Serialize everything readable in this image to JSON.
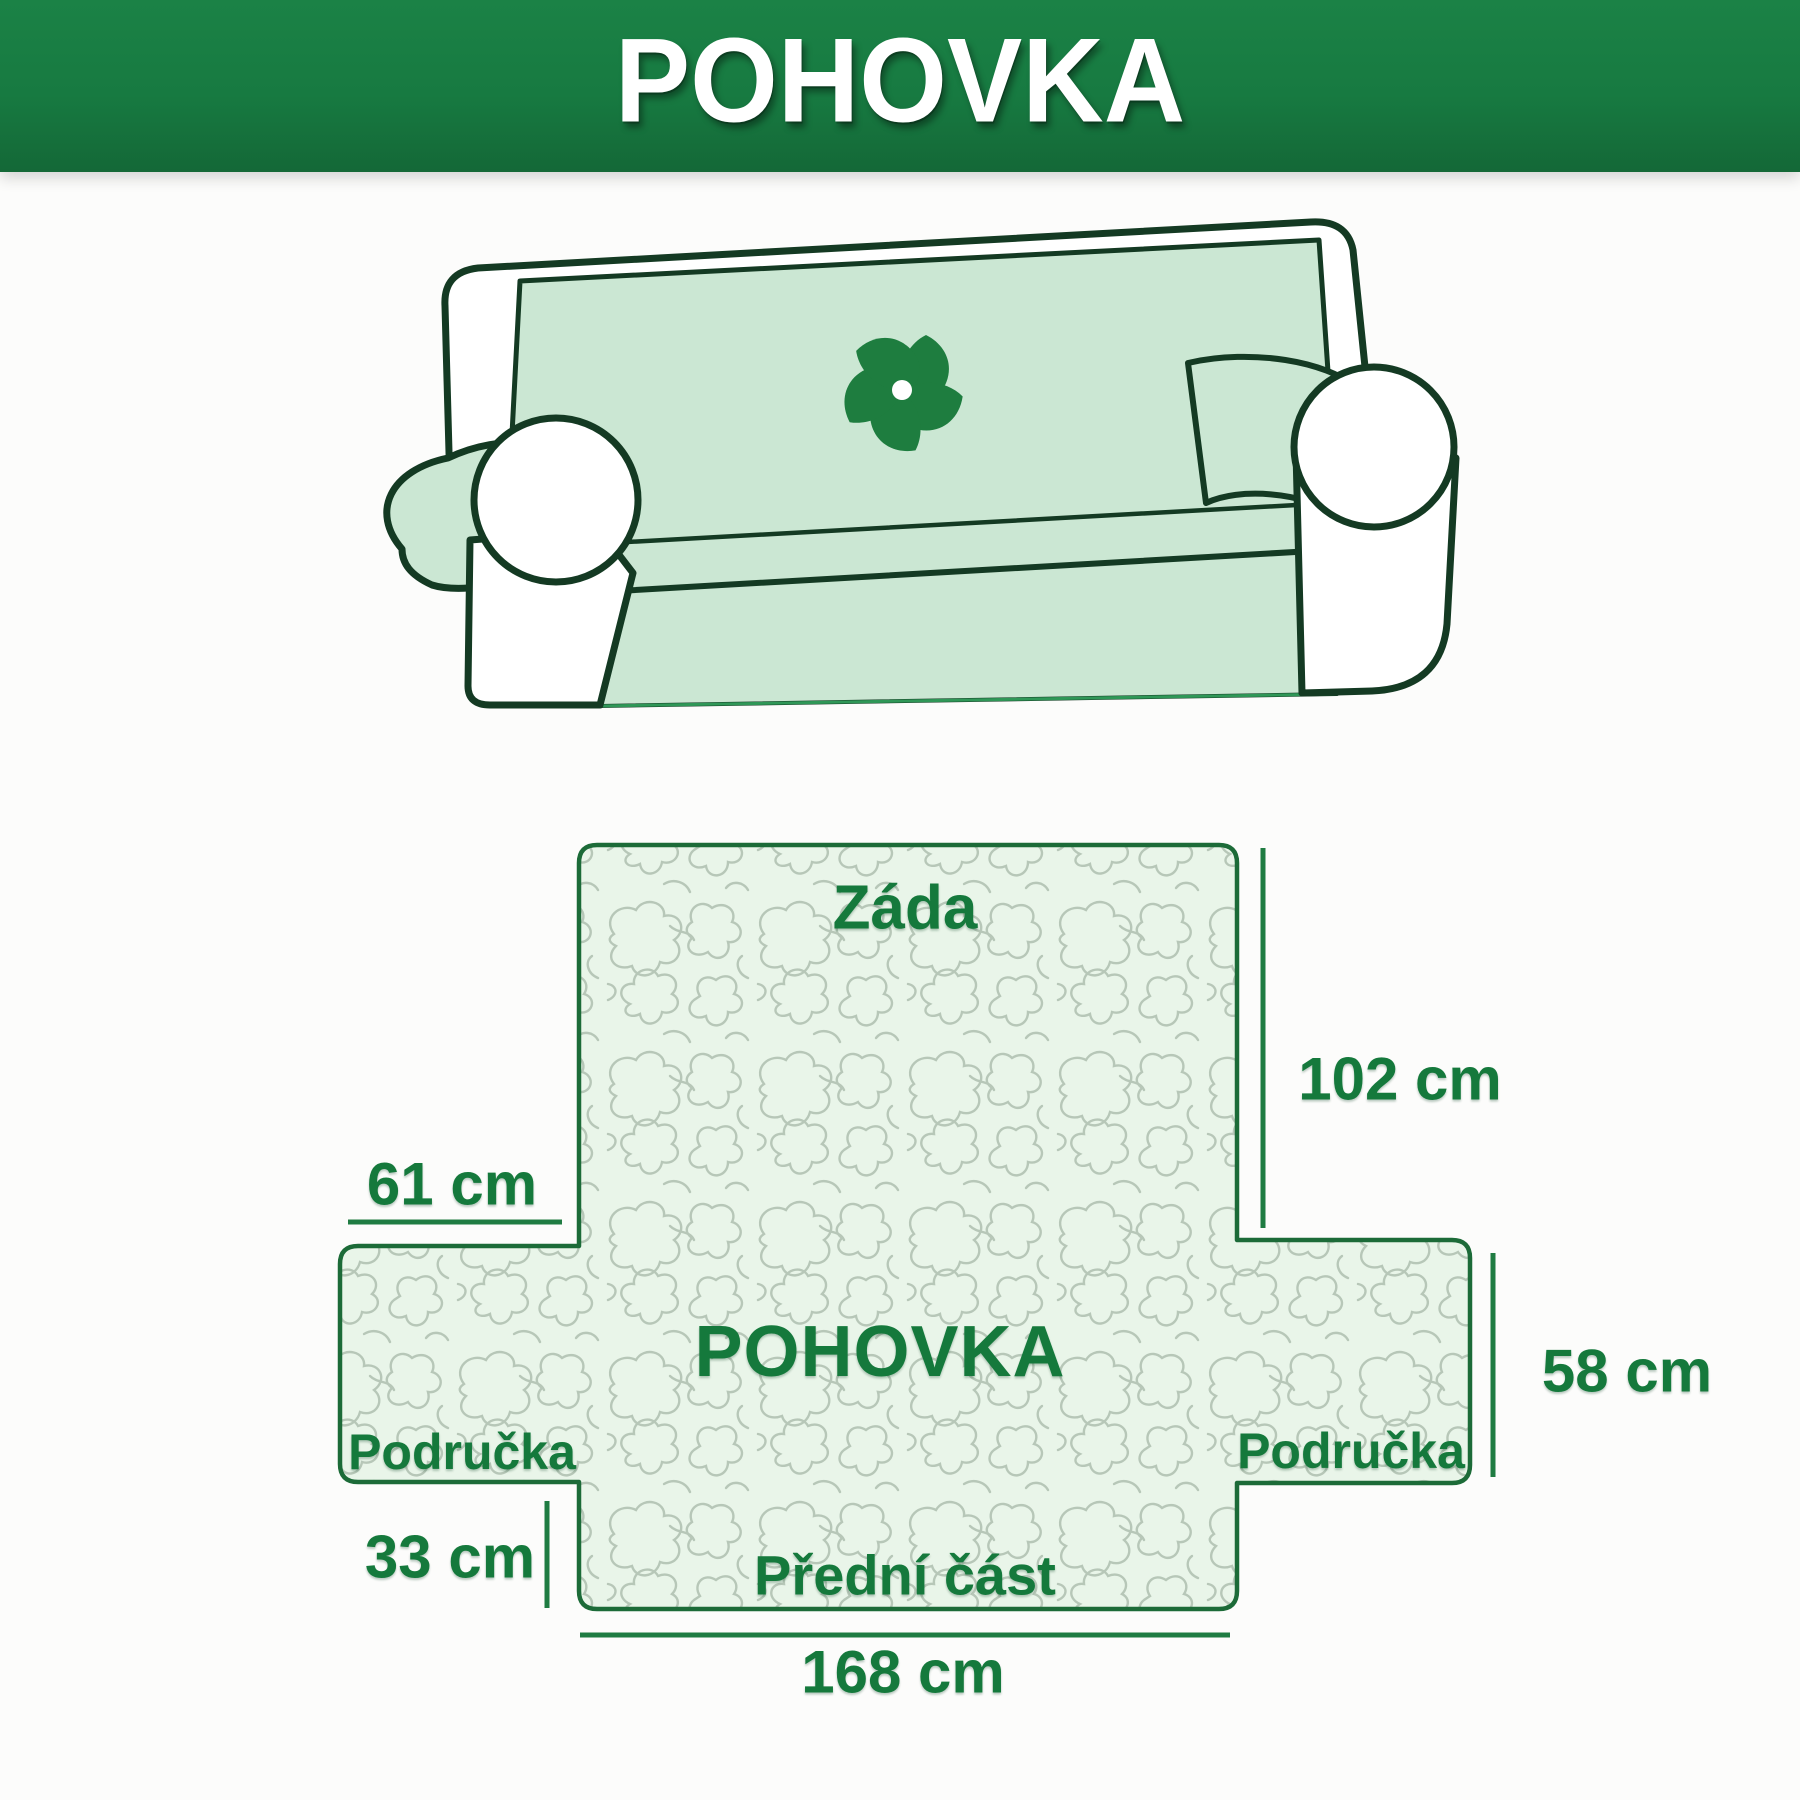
{
  "banner": {
    "title": "POHOVKA"
  },
  "sofa": {
    "logo_icon": "pinwheel-icon"
  },
  "diagram": {
    "back_label": "Záda",
    "center_label": "POHOVKA",
    "left_arm_label": "Područka",
    "right_arm_label": "Područka",
    "front_label": "Přední část",
    "dim_back_height": "102 cm",
    "dim_arm_top_width": "61 cm",
    "dim_arm_height": "58 cm",
    "dim_front_height": "33 cm",
    "dim_total_width": "168 cm"
  },
  "colors": {
    "banner_green": "#177a41",
    "label_green": "#15793c",
    "outline_green": "#1c6b38",
    "sofa_line": "#143a23",
    "cover_mint": "#cbe7d3",
    "panel_mint": "#e9f5e9",
    "pattern_line": "#b7c7b8",
    "logo_green": "#1e7d3f"
  }
}
